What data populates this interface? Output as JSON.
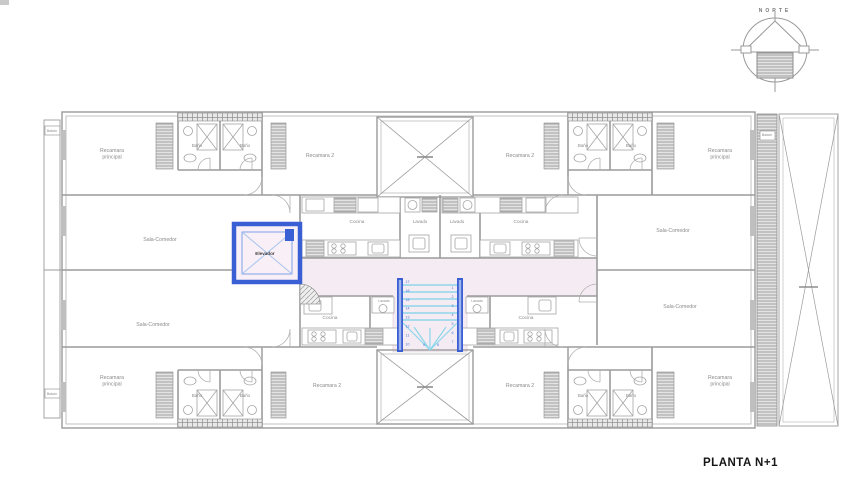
{
  "page": {
    "title": "PLANTA N+1"
  },
  "compass": {
    "label": "NORTE"
  },
  "colors": {
    "accent_blue": "#3a5ed4",
    "stair_cyan": "#8ed6ea",
    "corridor_pink": "#f5ecf3",
    "line_gray": "#9b9b9b",
    "label_gray": "#8a8a8a"
  },
  "plan": {
    "elevator": {
      "label": "Elevador"
    },
    "stairs": {
      "numbers_left": [
        "17",
        "16",
        "15",
        "14",
        "13",
        "12",
        "11",
        "10"
      ],
      "numbers_right": [
        "1",
        "2",
        "3",
        "4",
        "5",
        "6",
        "7"
      ],
      "numbers_bottom": [
        "8",
        "9"
      ]
    },
    "labels": [
      {
        "text": "Recamara\nprincipal",
        "x": 112,
        "y": 152,
        "size": 5.2
      },
      {
        "text": "Recamara 2",
        "x": 320,
        "y": 157,
        "size": 5.2
      },
      {
        "text": "Recamara 2",
        "x": 520,
        "y": 157,
        "size": 5.2
      },
      {
        "text": "Recamara\nprincipal",
        "x": 720,
        "y": 152,
        "size": 5.2
      },
      {
        "text": "Baño",
        "x": 197,
        "y": 147,
        "size": 4.4
      },
      {
        "text": "Baño",
        "x": 245,
        "y": 147,
        "size": 4.4
      },
      {
        "text": "Baño",
        "x": 583,
        "y": 147,
        "size": 4.4
      },
      {
        "text": "Baño",
        "x": 631,
        "y": 147,
        "size": 4.4
      },
      {
        "text": "Sala-Comedor",
        "x": 160,
        "y": 241,
        "size": 5.2
      },
      {
        "text": "Sala-Comedor",
        "x": 673,
        "y": 232,
        "size": 5.2
      },
      {
        "text": "Cocina",
        "x": 357,
        "y": 223,
        "size": 4.8
      },
      {
        "text": "Lavado",
        "x": 420,
        "y": 223,
        "size": 4.4
      },
      {
        "text": "Lavado",
        "x": 457,
        "y": 223,
        "size": 4.4
      },
      {
        "text": "Cocina",
        "x": 521,
        "y": 223,
        "size": 4.8
      },
      {
        "text": "Sala-Comedor",
        "x": 153,
        "y": 326,
        "size": 5.2
      },
      {
        "text": "Sala-Comedor",
        "x": 680,
        "y": 308,
        "size": 5.2
      },
      {
        "text": "Cocina",
        "x": 330,
        "y": 319,
        "size": 4.8
      },
      {
        "text": "Cocina",
        "x": 526,
        "y": 319,
        "size": 4.8
      },
      {
        "text": "Lavado",
        "x": 384,
        "y": 302,
        "size": 3.5
      },
      {
        "text": "Lavado",
        "x": 477,
        "y": 302,
        "size": 3.5
      },
      {
        "text": "Recamara\nprincipal",
        "x": 112,
        "y": 379,
        "size": 5.2
      },
      {
        "text": "Recamara 2",
        "x": 327,
        "y": 387,
        "size": 5.2
      },
      {
        "text": "Recamara 2",
        "x": 520,
        "y": 387,
        "size": 5.2
      },
      {
        "text": "Recamara\nprincipal",
        "x": 720,
        "y": 379,
        "size": 5.2
      },
      {
        "text": "Baño",
        "x": 197,
        "y": 397,
        "size": 4.4
      },
      {
        "text": "Baño",
        "x": 245,
        "y": 397,
        "size": 4.4
      },
      {
        "text": "Baño",
        "x": 583,
        "y": 397,
        "size": 4.4
      },
      {
        "text": "Baño",
        "x": 631,
        "y": 397,
        "size": 4.4
      },
      {
        "text": "Balcón",
        "x": 52,
        "y": 132,
        "size": 3.4
      },
      {
        "text": "Balcón",
        "x": 52,
        "y": 395,
        "size": 3.4
      },
      {
        "text": "Balcón",
        "x": 767,
        "y": 136,
        "size": 3.4
      }
    ]
  }
}
